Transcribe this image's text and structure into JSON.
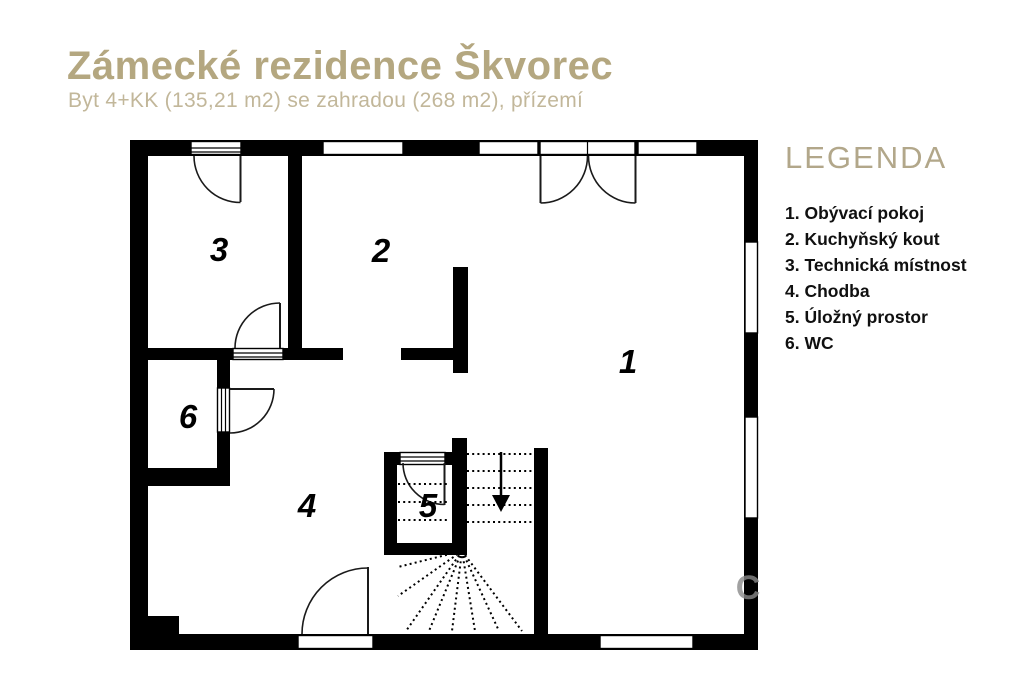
{
  "header": {
    "title": "Zámecké rezidence Škvorec",
    "subtitle": "Byt 4+KK (135,21 m2) se zahradou (268 m2), přízemí"
  },
  "legend": {
    "heading": "LEGENDA",
    "items": [
      {
        "text": "1. Obývací pokoj"
      },
      {
        "text": "2. Kuchyňský kout"
      },
      {
        "text": "3. Technická místnost"
      },
      {
        "text": "4. Chodba"
      },
      {
        "text": "5. Úložný prostor"
      },
      {
        "text": "6. WC"
      }
    ]
  },
  "plan": {
    "room_numbers": [
      "1",
      "2",
      "3",
      "4",
      "5",
      "6"
    ]
  },
  "watermark": {
    "letter": "C"
  },
  "colors": {
    "accent_tan": "#b4a780",
    "subtitle_tan": "#c2b79a",
    "legend_heading_tan": "#b2a78a",
    "wall_black": "#000000",
    "legend_text": "#101010"
  }
}
